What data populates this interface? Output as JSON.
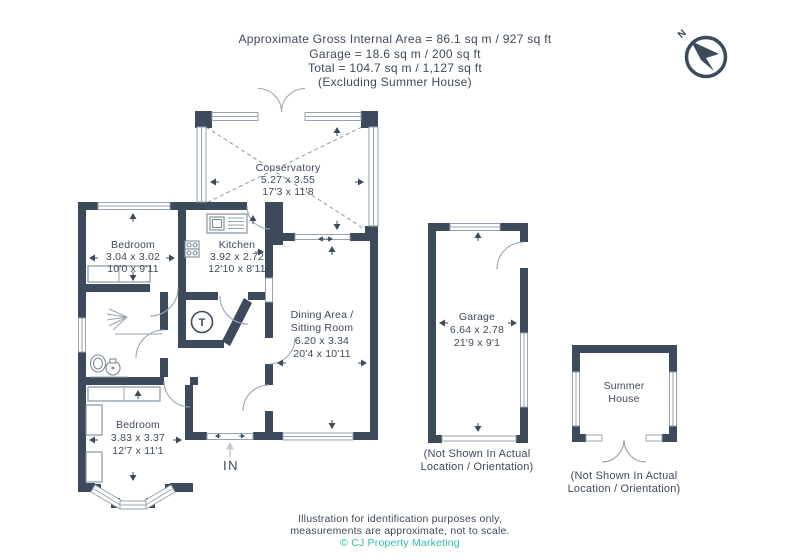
{
  "header": {
    "line1": "Approximate Gross Internal Area = 86.1 sq m / 927 sq ft",
    "line2": "Garage = 18.6 sq m / 200 sq ft",
    "line3": "Total = 104.7 sq m / 1,127 sq ft",
    "line4": "(Excluding Summer House)"
  },
  "compass": {
    "label": "N"
  },
  "rooms": {
    "conservatory": {
      "name": "Conservatory",
      "metric": "5.27 x 3.55",
      "imperial": "17'3 x 11'8"
    },
    "bedroom1": {
      "name": "Bedroom",
      "metric": "3.04 x 3.02",
      "imperial": "10'0 x 9'11"
    },
    "kitchen": {
      "name": "Kitchen",
      "metric": "3.92 x 2.72",
      "imperial": "12'10 x 8'11"
    },
    "dining": {
      "name1": "Dining Area /",
      "name2": "Sitting Room",
      "metric": "6.20 x 3.34",
      "imperial": "20'4 x 10'11"
    },
    "bedroom2": {
      "name": "Bedroom",
      "metric": "3.83 x 3.37",
      "imperial": "12'7 x 11'1"
    },
    "garage": {
      "name": "Garage",
      "metric": "6.64 x 2.78",
      "imperial": "21'9 x 9'1",
      "note1": "(Not Shown In Actual",
      "note2": "Location / Orientation)"
    },
    "summer_house": {
      "name1": "Summer",
      "name2": "House",
      "note1": "(Not Shown In Actual",
      "note2": "Location / Orientation)"
    }
  },
  "entrance": {
    "label": "IN"
  },
  "fixtures": {
    "tank": "T"
  },
  "footer": {
    "line1": "Illustration for identification purposes only,",
    "line2": "measurements are approximate, not to scale.",
    "line3": "© CJ Property Marketing"
  },
  "colors": {
    "wall": "#3d4a5c",
    "text": "#3e4a5b",
    "accent_teal": "#2fbda4",
    "window_line": "#98a3b0"
  }
}
